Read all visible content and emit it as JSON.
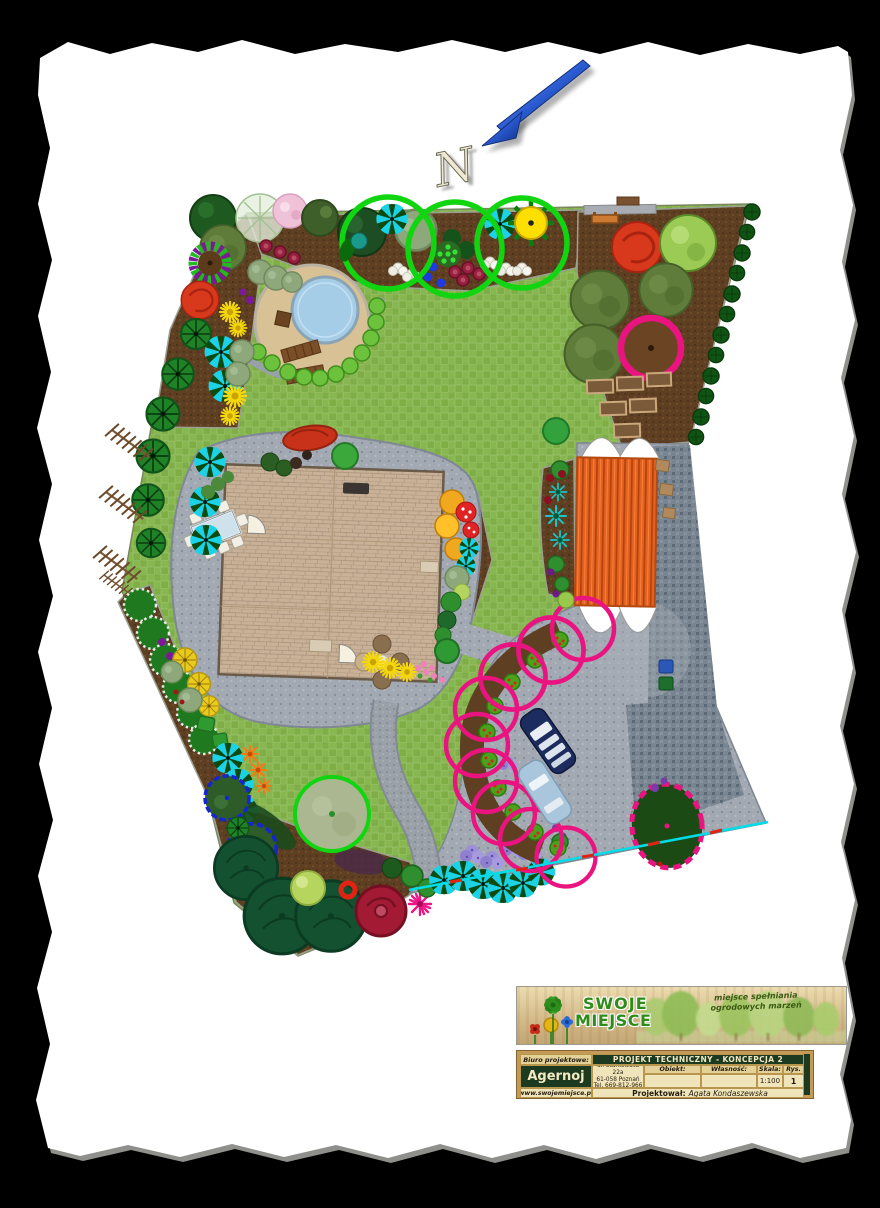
{
  "compass": {
    "label": "N"
  },
  "logo": {
    "brand_line1": "SWOJE",
    "brand_line2": "MIEJSCE",
    "tagline_line1": "miejsce spełniania",
    "tagline_line2": "ogrodowych marzeń"
  },
  "title_block": {
    "biuro_label": "Biuro projektowe:",
    "project_title": "PROJEKT TECHNICZNY - KONCEPCJA 2",
    "company": "Agernoj",
    "address_line1": "ul. Starkowska 22a",
    "address_line2": "61-058 Poznań",
    "address_line3": "Tel. 669-812-966",
    "obiekt_label": "Obiekt:",
    "wlasnosc_label": "Własność:",
    "skala_label": "Skala:",
    "skala_value": "1:100",
    "rys_label": "Rys.",
    "rys_value": "1",
    "website": "www.swojemiejsce.pl",
    "projektowal_label": "Projektował:",
    "projektowal_value": "Agata Kondaszewska"
  },
  "plan": {
    "colors": {
      "lawn": "#87b750",
      "lawn_alt": "#7fae47",
      "soil": "#5e3f22",
      "paving": "#a2a9b2",
      "paving_dark": "#75828e",
      "path": "#9aa1a8",
      "house_roof": "#c8b197",
      "garage": "#e8611c",
      "pool_water": "#a5cde8",
      "pool_deck": "#d9c196",
      "accent_pink": "#ea1480",
      "accent_green": "#10d510",
      "blue_outline": "#1626cf",
      "boundary_cyan": "#00dde8",
      "arrow_blue": "#2a5ad0"
    }
  }
}
